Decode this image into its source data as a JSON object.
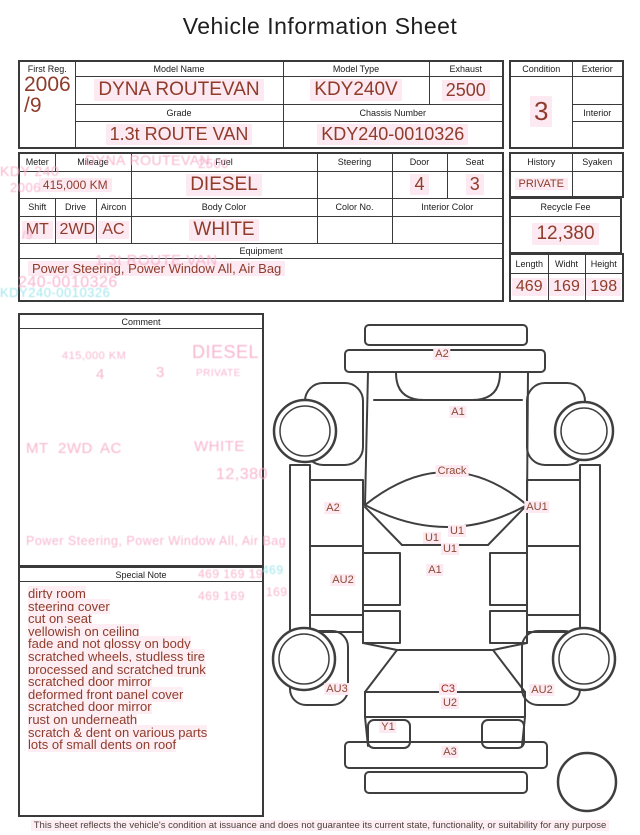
{
  "title": "Vehicle Information Sheet",
  "vehicle": {
    "first_reg_label": "First Reg.",
    "first_reg_line1": "2006",
    "first_reg_line2": "/9",
    "model_name_label": "Model Name",
    "model_name": "DYNA ROUTEVAN",
    "model_type_label": "Model Type",
    "model_type": "KDY240V",
    "exhaust_label": "Exhaust",
    "exhaust": "2500",
    "grade_label": "Grade",
    "grade": "1.3t ROUTE VAN",
    "chassis_label": "Chassis Number",
    "chassis_number": "KDY240-0010326",
    "condition_label": "Condition",
    "condition": "3",
    "exterior_label": "Exterior",
    "interior_label": "Interior"
  },
  "specs": {
    "meter_label": "Meter",
    "mileage_label": "Mileage",
    "mileage": "415,000 KM",
    "fuel_label": "Fuel",
    "fuel": "DIESEL",
    "steering_label": "Steering",
    "door_label": "Door",
    "door": "4",
    "seat_label": "Seat",
    "seat": "3",
    "shift_label": "Shift",
    "shift": "MT",
    "drive_label": "Drive",
    "drive": "2WD",
    "aircon_label": "Aircon",
    "aircon": "AC",
    "body_color_label": "Body Color",
    "body_color": "WHITE",
    "color_no_label": "Color No.",
    "interior_color_label": "Interior Color",
    "equipment_label": "Equipment",
    "equipment": "Power Steering, Power Window  All, Air Bag",
    "history_label": "History",
    "history": "PRIVATE",
    "syaken_label": "Syaken",
    "recycle_fee_label": "Recycle Fee",
    "recycle_fee": "12,380",
    "length_label": "Length",
    "length": "469",
    "width_label": "Widht",
    "width": "169",
    "height_label": "Height",
    "height": "198"
  },
  "comment": {
    "label": "Comment"
  },
  "special_note": {
    "label": "Special Note",
    "items": [
      "dirty room",
      "steering cover",
      "cut on seat",
      "yellowish on ceiling",
      "fade and not glossy on body",
      "scratched wheels, studless tire",
      "processed and scratched trunk",
      "scratched door mirror",
      "deformed front panel cover",
      "scratched door mirror",
      "rust on underneath",
      "scratch & dent on various parts",
      "lots of small dents on roof"
    ]
  },
  "diagram": {
    "labels": [
      {
        "text": "A2",
        "area": "front-bumper"
      },
      {
        "text": "A1",
        "area": "front-panel"
      },
      {
        "text": "Crack",
        "area": "windshield-roof"
      },
      {
        "text": "A2",
        "area": "left-front-door"
      },
      {
        "text": "AU1",
        "area": "right-front-door"
      },
      {
        "text": "U1",
        "area": "floor-1"
      },
      {
        "text": "U1",
        "area": "floor-2"
      },
      {
        "text": "U1",
        "area": "floor-3"
      },
      {
        "text": "A1",
        "area": "cargo-body"
      },
      {
        "text": "AU2",
        "area": "left-side-lower"
      },
      {
        "text": "AU3",
        "area": "left-rear-panel"
      },
      {
        "text": "C3",
        "area": "rear-gate"
      },
      {
        "text": "U2",
        "area": "rear-under"
      },
      {
        "text": "AU2",
        "area": "right-rear-panel"
      },
      {
        "text": "Y1",
        "area": "rear-corner"
      },
      {
        "text": "A3",
        "area": "rear-bumper"
      }
    ]
  },
  "ghosts": [
    "KDY 240",
    "2006",
    "/9",
    "DYNA ROUTEVAN",
    "2500",
    "KDY240-0010326",
    "1.3t ROUTE VAN",
    "240-0010326",
    "415,000 KM",
    "4",
    "3",
    "DIESEL",
    "PRIVATE",
    "MT",
    "2WD",
    "AC",
    "WHITE",
    "12,380",
    "Power Steering, Power Window All, Air Bag",
    "469  169  19",
    "469  169",
    "469",
    "169"
  ],
  "footer": "This sheet reflects the vehicle's condition at issuance and does not guarantee its current state, functionality, or suitability for any purpose",
  "colors": {
    "value_red": "#8f3c2b",
    "label_black": "#1b1b1b",
    "line_gray": "#3f3f3f",
    "highlight_pink": "#fce9f1",
    "ghost_pink": "#f6a8c6",
    "ghost_cyan": "#8adee6",
    "c3_red": "#a02818"
  }
}
